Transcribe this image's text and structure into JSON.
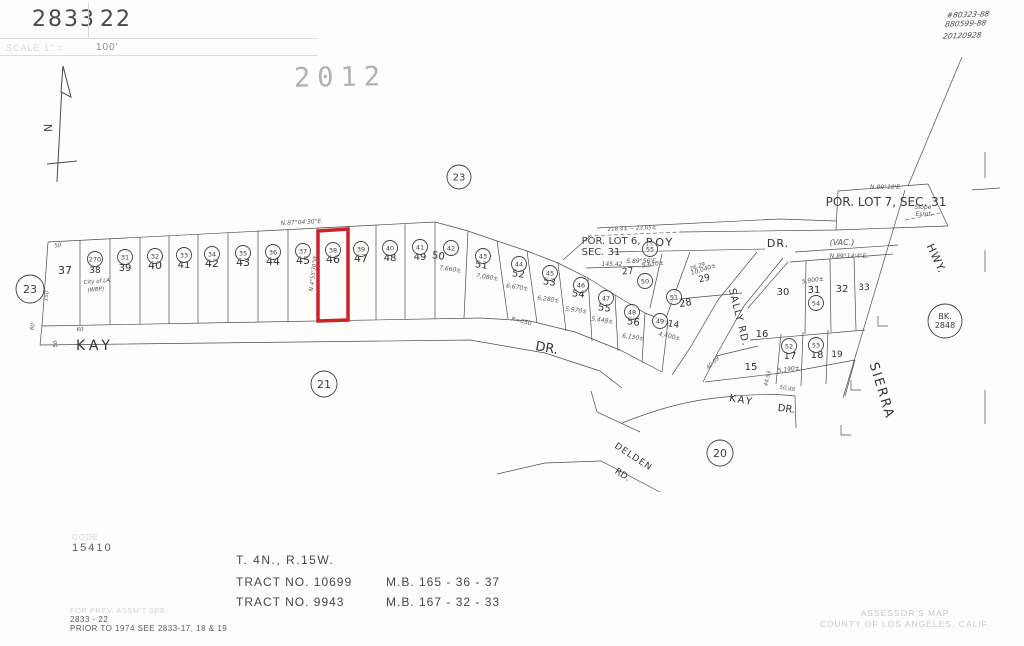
{
  "header": {
    "book": "2833",
    "page": "22",
    "scale_label": "SCALE 1\" =",
    "scale_value": "100'"
  },
  "stamps": {
    "year": "2012",
    "notes": [
      "#80323-88",
      "880599-88",
      "20120928"
    ]
  },
  "north_label": "N",
  "map": {
    "highlight_color": "#c8242a",
    "streets": [
      {
        "t": "KAY",
        "x": 95,
        "y": 350,
        "s": 14,
        "ls": 4
      },
      {
        "t": "DR.",
        "x": 546,
        "y": 352,
        "s": 13,
        "r": 10
      },
      {
        "t": "ROY",
        "x": 660,
        "y": 246,
        "s": 11,
        "ls": 2
      },
      {
        "t": "DR.",
        "x": 778,
        "y": 247,
        "s": 11,
        "ls": 1
      },
      {
        "t": "SALLY RD.",
        "x": 736,
        "y": 318,
        "s": 10,
        "r": 76,
        "ls": 1
      },
      {
        "t": "SIERRA",
        "x": 878,
        "y": 392,
        "s": 13,
        "r": 73,
        "ls": 2
      },
      {
        "t": "HWY.",
        "x": 933,
        "y": 260,
        "s": 11,
        "r": 65,
        "ls": 1
      },
      {
        "t": "KAY",
        "x": 741,
        "y": 403,
        "s": 10,
        "r": 10,
        "ls": 2
      },
      {
        "t": "DR.",
        "x": 786,
        "y": 412,
        "s": 10,
        "r": 8
      },
      {
        "t": "DELDEN",
        "x": 632,
        "y": 459,
        "s": 9,
        "r": 33,
        "ls": 1
      },
      {
        "t": "RD.",
        "x": 621,
        "y": 477,
        "s": 9,
        "r": 33
      }
    ],
    "annotations": [
      {
        "t": "POR. LOT 6,",
        "x": 611,
        "y": 244,
        "s": 10
      },
      {
        "t": "SEC. 31",
        "x": 601,
        "y": 255,
        "s": 10
      },
      {
        "t": "145.42",
        "x": 612,
        "y": 266,
        "s": 6,
        "c": "it"
      },
      {
        "t": "S.89°56'E.",
        "x": 642,
        "y": 263,
        "s": 6,
        "c": "it"
      },
      {
        "t": "POR. LOT 7, SEC. 31",
        "x": 886,
        "y": 206,
        "s": 12
      },
      {
        "t": "N.89°10'E.",
        "x": 886,
        "y": 189,
        "s": 6,
        "c": "it"
      },
      {
        "t": "Slope",
        "x": 923,
        "y": 209,
        "s": 6,
        "c": "it"
      },
      {
        "t": "Esmt.",
        "x": 924,
        "y": 216,
        "s": 6,
        "c": "it"
      },
      {
        "t": "(VAC.)",
        "x": 842,
        "y": 245,
        "s": 8,
        "c": "it"
      },
      {
        "t": "N.89°14'4\"E.",
        "x": 849,
        "y": 258,
        "s": 6,
        "c": "it"
      },
      {
        "t": "N.87°04'30\"E.",
        "x": 302,
        "y": 224,
        "s": 6,
        "c": "it",
        "r": -3
      },
      {
        "t": "N.4°55'30\"W.",
        "x": 315,
        "y": 273,
        "s": 5.5,
        "c": "it",
        "r": -83
      },
      {
        "t": "218.4± ~ 23.65±",
        "x": 632,
        "y": 230,
        "s": 5.5,
        "c": "it",
        "r": -2
      },
      {
        "t": "R=650",
        "x": 521,
        "y": 323,
        "s": 6,
        "c": "it",
        "r": 14
      },
      {
        "t": "76.29",
        "x": 698,
        "y": 268,
        "s": 5.5,
        "c": "it",
        "r": -20
      },
      {
        "t": "40.09",
        "x": 714,
        "y": 364,
        "s": 5.5,
        "c": "it",
        "r": -45
      },
      {
        "t": "44.53",
        "x": 769,
        "y": 379,
        "s": 5.5,
        "c": "it",
        "r": -75
      },
      {
        "t": "50.49",
        "x": 787,
        "y": 390,
        "s": 5.5,
        "c": "it",
        "r": 10
      },
      {
        "t": "7,660±",
        "x": 450,
        "y": 271,
        "s": 6,
        "c": "it",
        "r": 8
      },
      {
        "t": "7,080±",
        "x": 487,
        "y": 279,
        "s": 6,
        "c": "it",
        "r": 8
      },
      {
        "t": "6,670±",
        "x": 517,
        "y": 289,
        "s": 6,
        "c": "it",
        "r": 8
      },
      {
        "t": "6,280±",
        "x": 548,
        "y": 301,
        "s": 6,
        "c": "it",
        "r": 8
      },
      {
        "t": "5,970±",
        "x": 576,
        "y": 312,
        "s": 6,
        "c": "it",
        "r": 8
      },
      {
        "t": "5,448±",
        "x": 602,
        "y": 322,
        "s": 6,
        "c": "it",
        "r": 8
      },
      {
        "t": "6,150±",
        "x": 633,
        "y": 339,
        "s": 6,
        "c": "it",
        "r": 8
      },
      {
        "t": "4,400±",
        "x": 669,
        "y": 338,
        "s": 6,
        "c": "it",
        "r": 12
      },
      {
        "t": "5,610±",
        "x": 653,
        "y": 266,
        "s": 6,
        "c": "it",
        "r": -8
      },
      {
        "t": "10,040±",
        "x": 704,
        "y": 271,
        "s": 6,
        "c": "it",
        "r": -18
      },
      {
        "t": "5,900±",
        "x": 813,
        "y": 282,
        "s": 6,
        "c": "it",
        "r": -8
      },
      {
        "t": "5,190±",
        "x": 789,
        "y": 371,
        "s": 6,
        "c": "it",
        "r": -8
      },
      {
        "t": "City of LA",
        "x": 97,
        "y": 283,
        "s": 5.5,
        "c": "hand",
        "r": -5
      },
      {
        "t": "(WBP)",
        "x": 96,
        "y": 291,
        "s": 5.5,
        "c": "hand",
        "r": -5
      },
      {
        "t": "50",
        "x": 58,
        "y": 247,
        "s": 5.5,
        "c": "it",
        "r": -8
      },
      {
        "t": "150",
        "x": 48,
        "y": 296,
        "s": 5.5,
        "c": "it",
        "r": -82
      },
      {
        "t": "60",
        "x": 34,
        "y": 327,
        "s": 5.5,
        "c": "it",
        "r": -78
      },
      {
        "t": "60",
        "x": 80,
        "y": 331,
        "s": 5.5,
        "c": "it"
      },
      {
        "t": "50",
        "x": 57,
        "y": 344,
        "s": 5.5,
        "c": "it",
        "r": -90
      }
    ],
    "lots": [
      {
        "t": "37",
        "x": 65,
        "y": 274,
        "s": 11
      },
      {
        "t": "38",
        "x": 95,
        "y": 273,
        "s": 9
      },
      {
        "t": "39",
        "x": 125,
        "y": 271,
        "s": 10
      },
      {
        "t": "40",
        "x": 155,
        "y": 269,
        "s": 11
      },
      {
        "t": "41",
        "x": 184,
        "y": 268,
        "s": 10
      },
      {
        "t": "42",
        "x": 212,
        "y": 267,
        "s": 11
      },
      {
        "t": "43",
        "x": 243,
        "y": 266,
        "s": 11
      },
      {
        "t": "44",
        "x": 273,
        "y": 265,
        "s": 11
      },
      {
        "t": "45",
        "x": 303,
        "y": 264,
        "s": 11
      },
      {
        "t": "46",
        "x": 333,
        "y": 263,
        "s": 11
      },
      {
        "t": "47",
        "x": 361,
        "y": 262,
        "s": 11
      },
      {
        "t": "48",
        "x": 390,
        "y": 261,
        "s": 10
      },
      {
        "t": "49",
        "x": 420,
        "y": 260,
        "s": 10
      },
      {
        "t": "50",
        "x": 438,
        "y": 259,
        "s": 10,
        "r": 8
      },
      {
        "t": "51",
        "x": 481,
        "y": 268,
        "s": 10,
        "r": 8
      },
      {
        "t": "52",
        "x": 518,
        "y": 277,
        "s": 10,
        "r": 8
      },
      {
        "t": "53",
        "x": 549,
        "y": 285,
        "s": 10,
        "r": 8
      },
      {
        "t": "54",
        "x": 578,
        "y": 297,
        "s": 10,
        "r": 8
      },
      {
        "t": "55",
        "x": 604,
        "y": 311,
        "s": 10,
        "r": 8
      },
      {
        "t": "56",
        "x": 633,
        "y": 325,
        "s": 10,
        "r": 8
      },
      {
        "t": "14",
        "x": 673,
        "y": 327,
        "s": 9,
        "r": 10
      },
      {
        "t": "27",
        "x": 628,
        "y": 274,
        "s": 9,
        "r": -5
      },
      {
        "t": "28",
        "x": 686,
        "y": 306,
        "s": 10,
        "r": -10
      },
      {
        "t": "29",
        "x": 705,
        "y": 281,
        "s": 9,
        "r": -15
      },
      {
        "t": "30",
        "x": 783,
        "y": 295,
        "s": 10
      },
      {
        "t": "31",
        "x": 814,
        "y": 293,
        "s": 10
      },
      {
        "t": "32",
        "x": 842,
        "y": 292,
        "s": 10
      },
      {
        "t": "33",
        "x": 864,
        "y": 290,
        "s": 9
      },
      {
        "t": "16",
        "x": 762,
        "y": 337,
        "s": 10
      },
      {
        "t": "17",
        "x": 790,
        "y": 359,
        "s": 10
      },
      {
        "t": "18",
        "x": 817,
        "y": 358,
        "s": 10
      },
      {
        "t": "19",
        "x": 837,
        "y": 357,
        "s": 9
      },
      {
        "t": "15",
        "x": 751,
        "y": 370,
        "s": 10
      }
    ],
    "parcel_circles": [
      {
        "t": "270",
        "x": 95,
        "y": 259
      },
      {
        "t": "31",
        "x": 125,
        "y": 257
      },
      {
        "t": "32",
        "x": 155,
        "y": 256
      },
      {
        "t": "33",
        "x": 184,
        "y": 255
      },
      {
        "t": "34",
        "x": 212,
        "y": 254
      },
      {
        "t": "35",
        "x": 243,
        "y": 253
      },
      {
        "t": "36",
        "x": 273,
        "y": 252
      },
      {
        "t": "37",
        "x": 303,
        "y": 251
      },
      {
        "t": "38",
        "x": 333,
        "y": 250
      },
      {
        "t": "39",
        "x": 361,
        "y": 249
      },
      {
        "t": "40",
        "x": 390,
        "y": 248
      },
      {
        "t": "41",
        "x": 420,
        "y": 247
      },
      {
        "t": "42",
        "x": 451,
        "y": 248
      },
      {
        "t": "43",
        "x": 483,
        "y": 256
      },
      {
        "t": "44",
        "x": 519,
        "y": 264
      },
      {
        "t": "45",
        "x": 550,
        "y": 273
      },
      {
        "t": "46",
        "x": 581,
        "y": 285
      },
      {
        "t": "47",
        "x": 606,
        "y": 298
      },
      {
        "t": "48",
        "x": 632,
        "y": 312
      },
      {
        "t": "49",
        "x": 660,
        "y": 321
      },
      {
        "t": "50",
        "x": 645,
        "y": 281
      },
      {
        "t": "51",
        "x": 674,
        "y": 297
      },
      {
        "t": "52",
        "x": 789,
        "y": 346
      },
      {
        "t": "53",
        "x": 816,
        "y": 345
      },
      {
        "t": "54",
        "x": 816,
        "y": 303
      },
      {
        "t": "55",
        "x": 650,
        "y": 249
      }
    ],
    "ref_circles": [
      {
        "t": "23",
        "x": 459,
        "y": 177,
        "r": 12,
        "s": 10
      },
      {
        "t": "23",
        "x": 30,
        "y": 289,
        "r": 14,
        "s": 11
      },
      {
        "t": "21",
        "x": 324,
        "y": 384,
        "r": 13,
        "s": 11
      },
      {
        "t": "20",
        "x": 720,
        "y": 453,
        "r": 13,
        "s": 11
      },
      {
        "t": "BK.|2848",
        "x": 945,
        "y": 321,
        "r": 17,
        "s": 8
      }
    ]
  },
  "footer": {
    "code_label": "CODE",
    "code_value": "15410",
    "prev_faded": "FOR PREV. ASSM'T SEE",
    "prev_ref": "2833 - 22",
    "prev_note": "PRIOR TO 1974 SEE 2833-17, 18 & 19",
    "township": "T. 4N., R.15W.",
    "tracts": [
      {
        "name": "TRACT NO. 10699",
        "mb": "M.B. 165 - 36 - 37"
      },
      {
        "name": "TRACT NO. 9943",
        "mb": "M.B. 167 - 32 - 33"
      }
    ],
    "credit_line1": "ASSESSOR'S MAP",
    "credit_line2": "COUNTY OF LOS ANGELES, CALIF."
  }
}
